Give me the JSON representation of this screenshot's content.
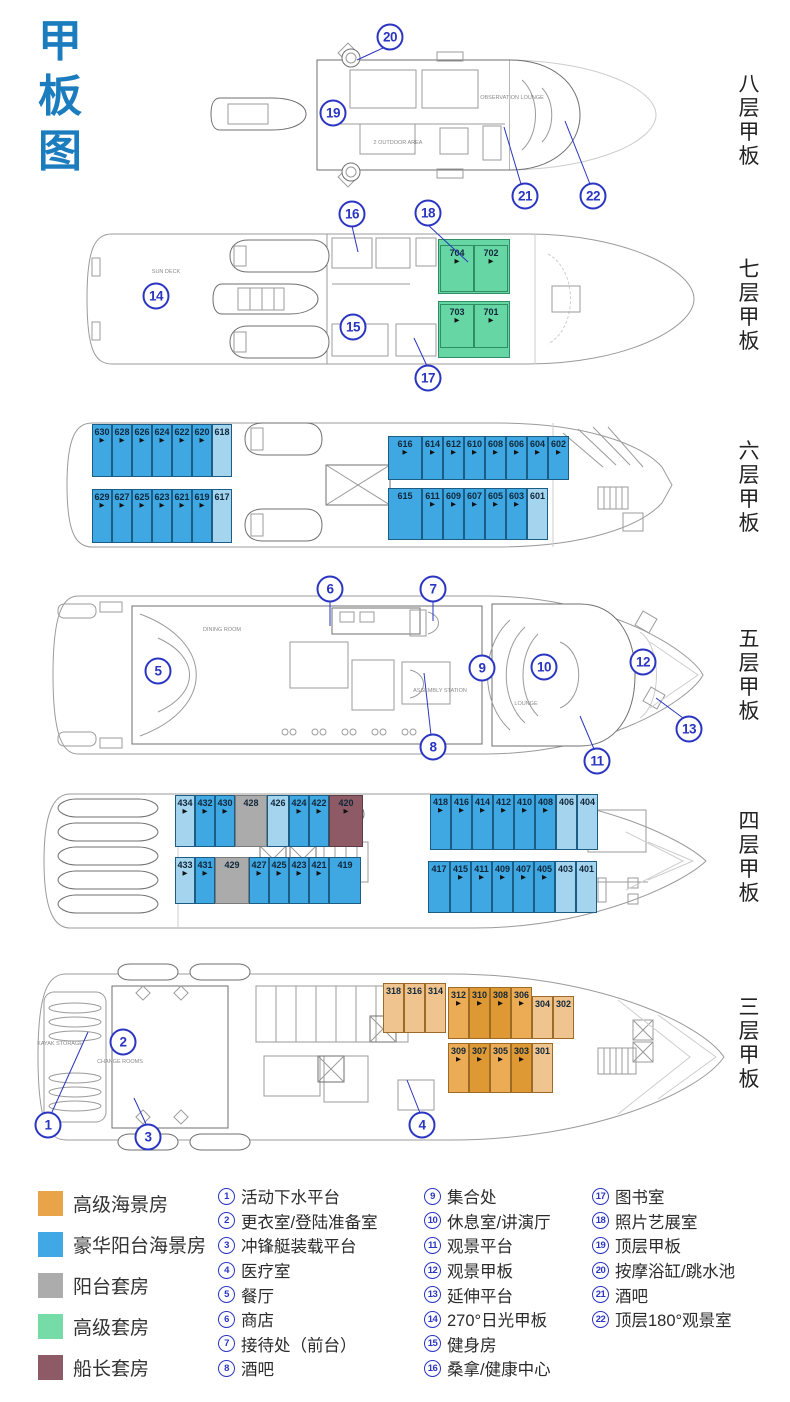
{
  "title": {
    "text": "甲\n板\n图"
  },
  "icons": {
    "room_arrow": "▶"
  },
  "colors": {
    "title_blue": "#1B7CBE",
    "callout_blue": "#2A35C1",
    "deluxe_balcony_blue": "#3FA7E2",
    "light_blue": "#A5D4EE",
    "premium_seaview_orange": "#E9A449",
    "balcony_suite_gray": "#ACACAC",
    "premium_suite_green": "#76DCA7",
    "captain_suite_maroon": "#8E5A66"
  },
  "decks": [
    {
      "name": "deck-8",
      "label": "八层甲板",
      "callouts": [
        {
          "n": "20",
          "x": 390,
          "y": 37
        },
        {
          "n": "19",
          "x": 333,
          "y": 113
        },
        {
          "n": "21",
          "x": 525,
          "y": 196
        },
        {
          "n": "22",
          "x": 593,
          "y": 196
        }
      ],
      "notes": [
        {
          "t": "OBSERVATION LOUNGE",
          "x": 512,
          "y": 98
        },
        {
          "t": "2 OUTDOOR AREA",
          "x": 398,
          "y": 143
        }
      ]
    },
    {
      "name": "deck-7",
      "label": "七层甲板",
      "callouts": [
        {
          "n": "16",
          "x": 352,
          "y": 214
        },
        {
          "n": "18",
          "x": 428,
          "y": 213
        },
        {
          "n": "14",
          "x": 156,
          "y": 296
        },
        {
          "n": "15",
          "x": 353,
          "y": 327
        },
        {
          "n": "17",
          "x": 428,
          "y": 378
        }
      ],
      "notes": [
        {
          "t": "SUN DECK",
          "x": 166,
          "y": 272
        }
      ],
      "rooms": {
        "g1": [
          {
            "num": "704",
            "c": "gn"
          },
          {
            "num": "702",
            "c": "gn"
          }
        ],
        "g2": [
          {
            "num": "703",
            "c": "gn"
          },
          {
            "num": "701",
            "c": "gn"
          }
        ]
      }
    },
    {
      "name": "deck-6",
      "label": "六层甲板",
      "callouts": [],
      "notes": [],
      "rooms": {
        "lt": [
          {
            "num": "630",
            "c": "b"
          },
          {
            "num": "628",
            "c": "b"
          },
          {
            "num": "626",
            "c": "b"
          },
          {
            "num": "624",
            "c": "b"
          },
          {
            "num": "622",
            "c": "b"
          },
          {
            "num": "620",
            "c": "b"
          },
          {
            "num": "618",
            "c": "lb na"
          }
        ],
        "lb": [
          {
            "num": "629",
            "c": "b"
          },
          {
            "num": "627",
            "c": "b"
          },
          {
            "num": "625",
            "c": "b"
          },
          {
            "num": "623",
            "c": "b"
          },
          {
            "num": "621",
            "c": "b"
          },
          {
            "num": "619",
            "c": "b"
          },
          {
            "num": "617",
            "c": "lb na"
          }
        ],
        "rt": [
          {
            "num": "616",
            "c": "b",
            "w": 34
          },
          {
            "num": "614",
            "c": "b"
          },
          {
            "num": "612",
            "c": "b"
          },
          {
            "num": "610",
            "c": "b"
          },
          {
            "num": "608",
            "c": "b"
          },
          {
            "num": "606",
            "c": "b"
          },
          {
            "num": "604",
            "c": "b"
          },
          {
            "num": "602",
            "c": "b"
          }
        ],
        "rb": [
          {
            "num": "615",
            "c": "b na",
            "w": 34
          },
          {
            "num": "611",
            "c": "b"
          },
          {
            "num": "609",
            "c": "b"
          },
          {
            "num": "607",
            "c": "b"
          },
          {
            "num": "605",
            "c": "b"
          },
          {
            "num": "603",
            "c": "b"
          },
          {
            "num": "601",
            "c": "lb na"
          }
        ]
      }
    },
    {
      "name": "deck-5",
      "label": "五层甲板",
      "callouts": [
        {
          "n": "6",
          "x": 330,
          "y": 589
        },
        {
          "n": "7",
          "x": 433,
          "y": 589
        },
        {
          "n": "5",
          "x": 158,
          "y": 671
        },
        {
          "n": "9",
          "x": 482,
          "y": 668
        },
        {
          "n": "10",
          "x": 544,
          "y": 667
        },
        {
          "n": "12",
          "x": 643,
          "y": 662
        },
        {
          "n": "8",
          "x": 433,
          "y": 747
        },
        {
          "n": "11",
          "x": 597,
          "y": 761
        },
        {
          "n": "13",
          "x": 689,
          "y": 729
        }
      ],
      "notes": [
        {
          "t": "DINING ROOM",
          "x": 222,
          "y": 630
        },
        {
          "t": "ASSEMBLY STATION",
          "x": 440,
          "y": 691
        },
        {
          "t": "LOUNGE",
          "x": 526,
          "y": 704
        }
      ]
    },
    {
      "name": "deck-4",
      "label": "四层甲板",
      "callouts": [],
      "notes": [],
      "rooms": {
        "lt": [
          {
            "num": "434",
            "c": "lb"
          },
          {
            "num": "432",
            "c": "b"
          },
          {
            "num": "430",
            "c": "b"
          },
          {
            "num": "428",
            "c": "g na",
            "w": 32
          },
          {
            "num": "426",
            "c": "lb na",
            "w": 22
          },
          {
            "num": "424",
            "c": "b"
          },
          {
            "num": "422",
            "c": "b"
          },
          {
            "num": "420",
            "c": "m",
            "w": 34
          }
        ],
        "lb": [
          {
            "num": "433",
            "c": "lb"
          },
          {
            "num": "431",
            "c": "b"
          },
          {
            "num": "429",
            "c": "g na",
            "w": 34
          },
          {
            "num": "427",
            "c": "b"
          },
          {
            "num": "425",
            "c": "b"
          },
          {
            "num": "423",
            "c": "b"
          },
          {
            "num": "421",
            "c": "b"
          },
          {
            "num": "419",
            "c": "b na",
            "w": 32
          }
        ],
        "rt": [
          {
            "num": "418",
            "c": "b"
          },
          {
            "num": "416",
            "c": "b"
          },
          {
            "num": "414",
            "c": "b"
          },
          {
            "num": "412",
            "c": "b"
          },
          {
            "num": "410",
            "c": "b"
          },
          {
            "num": "408",
            "c": "b"
          },
          {
            "num": "406",
            "c": "lb na"
          },
          {
            "num": "404",
            "c": "lb na"
          }
        ],
        "rb": [
          {
            "num": "417",
            "c": "b na",
            "w": 22
          },
          {
            "num": "415",
            "c": "b"
          },
          {
            "num": "411",
            "c": "b"
          },
          {
            "num": "409",
            "c": "b"
          },
          {
            "num": "407",
            "c": "b"
          },
          {
            "num": "405",
            "c": "b"
          },
          {
            "num": "403",
            "c": "lb na"
          },
          {
            "num": "401",
            "c": "lb na"
          }
        ]
      }
    },
    {
      "name": "deck-3",
      "label": "三层甲板",
      "callouts": [
        {
          "n": "2",
          "x": 123,
          "y": 1042
        },
        {
          "n": "1",
          "x": 48,
          "y": 1125
        },
        {
          "n": "3",
          "x": 148,
          "y": 1137
        },
        {
          "n": "4",
          "x": 422,
          "y": 1125
        }
      ],
      "notes": [
        {
          "t": "KAYAK STORAGE",
          "x": 60,
          "y": 1044
        },
        {
          "t": "CHANGE ROOMS",
          "x": 120,
          "y": 1062
        }
      ],
      "rooms": {
        "a": [
          {
            "num": "318",
            "c": "o1 na"
          },
          {
            "num": "316",
            "c": "o1 na"
          },
          {
            "num": "314",
            "c": "o1 na"
          }
        ],
        "bt": [
          {
            "num": "312",
            "c": "o2"
          },
          {
            "num": "310",
            "c": "o3"
          },
          {
            "num": "308",
            "c": "o3"
          },
          {
            "num": "306",
            "c": "o2"
          },
          {
            "num": "304",
            "c": "o1 na off"
          },
          {
            "num": "302",
            "c": "o1 na off"
          }
        ],
        "bb": [
          {
            "num": "309",
            "c": "o2"
          },
          {
            "num": "307",
            "c": "o3"
          },
          {
            "num": "305",
            "c": "o2"
          },
          {
            "num": "303",
            "c": "o3"
          },
          {
            "num": "301",
            "c": "o1 na"
          }
        ]
      }
    }
  ],
  "legend": {
    "room_types": [
      {
        "label": "高级海景房",
        "color": "#E9A449"
      },
      {
        "label": "豪华阳台海景房",
        "color": "#41A8E6"
      },
      {
        "label": "阳台套房",
        "color": "#ACACAC"
      },
      {
        "label": "高级套房",
        "color": "#76DCA7"
      },
      {
        "label": "船长套房",
        "color": "#8E5A66"
      }
    ],
    "facilities_col1": [
      {
        "n": "1",
        "label": "活动下水平台"
      },
      {
        "n": "2",
        "label": "更衣室/登陆准备室"
      },
      {
        "n": "3",
        "label": "冲锋艇装载平台"
      },
      {
        "n": "4",
        "label": "医疗室"
      },
      {
        "n": "5",
        "label": "餐厅"
      },
      {
        "n": "6",
        "label": "商店"
      },
      {
        "n": "7",
        "label": "接待处（前台）"
      },
      {
        "n": "8",
        "label": "酒吧"
      }
    ],
    "facilities_col2": [
      {
        "n": "9",
        "label": "集合处"
      },
      {
        "n": "10",
        "label": "休息室/讲演厅"
      },
      {
        "n": "11",
        "label": "观景平台"
      },
      {
        "n": "12",
        "label": "观景甲板"
      },
      {
        "n": "13",
        "label": "延伸平台"
      },
      {
        "n": "14",
        "label": "270°日光甲板"
      },
      {
        "n": "15",
        "label": "健身房"
      },
      {
        "n": "16",
        "label": "桑拿/健康中心"
      }
    ],
    "facilities_col3": [
      {
        "n": "17",
        "label": "图书室"
      },
      {
        "n": "18",
        "label": "照片艺展室"
      },
      {
        "n": "19",
        "label": "顶层甲板"
      },
      {
        "n": "20",
        "label": "按摩浴缸/跳水池"
      },
      {
        "n": "21",
        "label": "酒吧"
      },
      {
        "n": "22",
        "label": "顶层180°观景室"
      }
    ]
  }
}
